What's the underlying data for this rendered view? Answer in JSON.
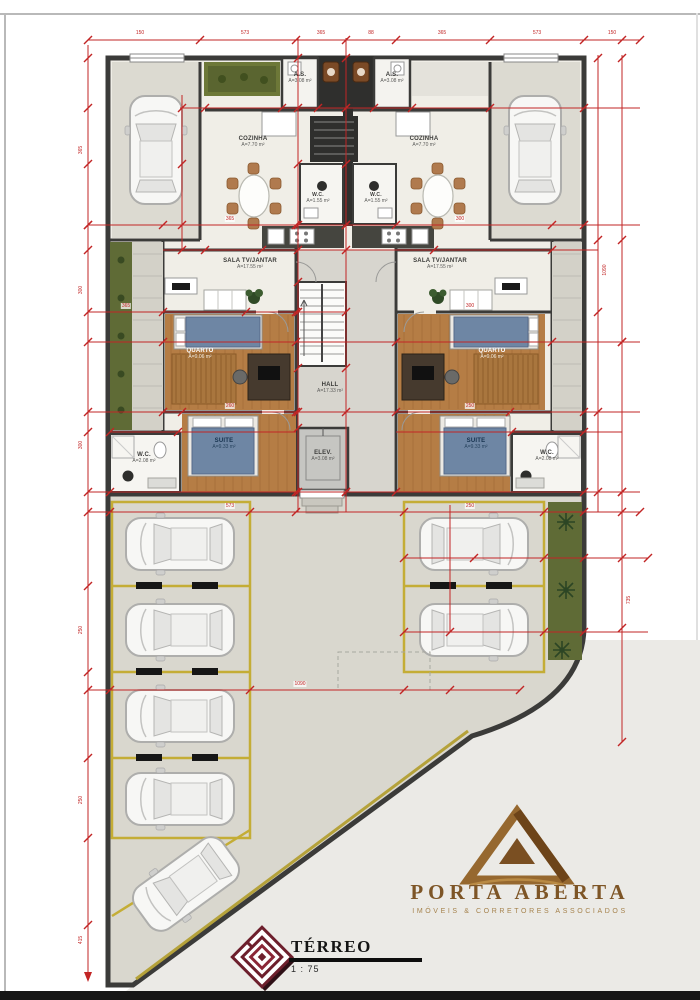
{
  "document": {
    "type": "floor-plan",
    "sheet_title": "TÉRREO",
    "sheet_scale": "1 : 75"
  },
  "title_block": {
    "title": "TÉRREO",
    "scale": "1 : 75"
  },
  "brand": {
    "name": "PORTA ABERTA",
    "tagline": "IMÓVEIS & CORRETORES ASSOCIADOS"
  },
  "rooms": {
    "as_left": {
      "name": "A.S.",
      "area": "A=3.08 m²"
    },
    "as_right": {
      "name": "A.S.",
      "area": "A=3.08 m²"
    },
    "cozinha_left": {
      "name": "COZINHA",
      "area": "A=7.70 m²"
    },
    "cozinha_right": {
      "name": "COZINHA",
      "area": "A=7.70 m²"
    },
    "sala_left": {
      "name": "SALA TV/JANTAR",
      "area": "A=17.55 m²"
    },
    "sala_right": {
      "name": "SALA TV/JANTAR",
      "area": "A=17.55 m²"
    },
    "lavabo_left": {
      "name": "W.C.",
      "area": "A=1.55 m²"
    },
    "lavabo_right": {
      "name": "W.C.",
      "area": "A=1.55 m²"
    },
    "quarto_left": {
      "name": "QUARTO",
      "area": "A=9.06 m²"
    },
    "quarto_right": {
      "name": "QUARTO",
      "area": "A=9.06 m²"
    },
    "hall": {
      "name": "HALL",
      "area": "A=17.33 m²"
    },
    "suite_left": {
      "name": "SUITE",
      "area": "A=9.33 m²"
    },
    "suite_right": {
      "name": "SUITE",
      "area": "A=9.33 m²"
    },
    "elev": {
      "name": "ELEV.",
      "area": "A=3.08 m²"
    },
    "wc_left": {
      "name": "W.C.",
      "area": "A=2.08 m²"
    },
    "wc_right": {
      "name": "W.C.",
      "area": "A=2.08 m²"
    }
  },
  "dims": {
    "top": [
      "150",
      "573",
      "365",
      "88",
      "365",
      "573",
      "150"
    ],
    "left": [
      "365",
      "300",
      "300",
      "250",
      "250",
      "415"
    ],
    "right": [
      "1090",
      "735"
    ],
    "inner": [
      "365",
      "300",
      "365",
      "300",
      "260",
      "250",
      "573",
      "250"
    ],
    "bottom": [
      "1090"
    ]
  },
  "parking": {
    "left_stalls": 5,
    "right_stalls": 2,
    "garage_stalls": 2
  },
  "colors": {
    "dimension_red": "#c22525",
    "stall_yellow": "#c4ad36",
    "wood": "#b57d45",
    "bed_blue": "#6e86a4",
    "garden_green": "#5f6b36",
    "brand_bronze": "#8a5e2e",
    "logo_maroon": "#6d1f2c"
  }
}
